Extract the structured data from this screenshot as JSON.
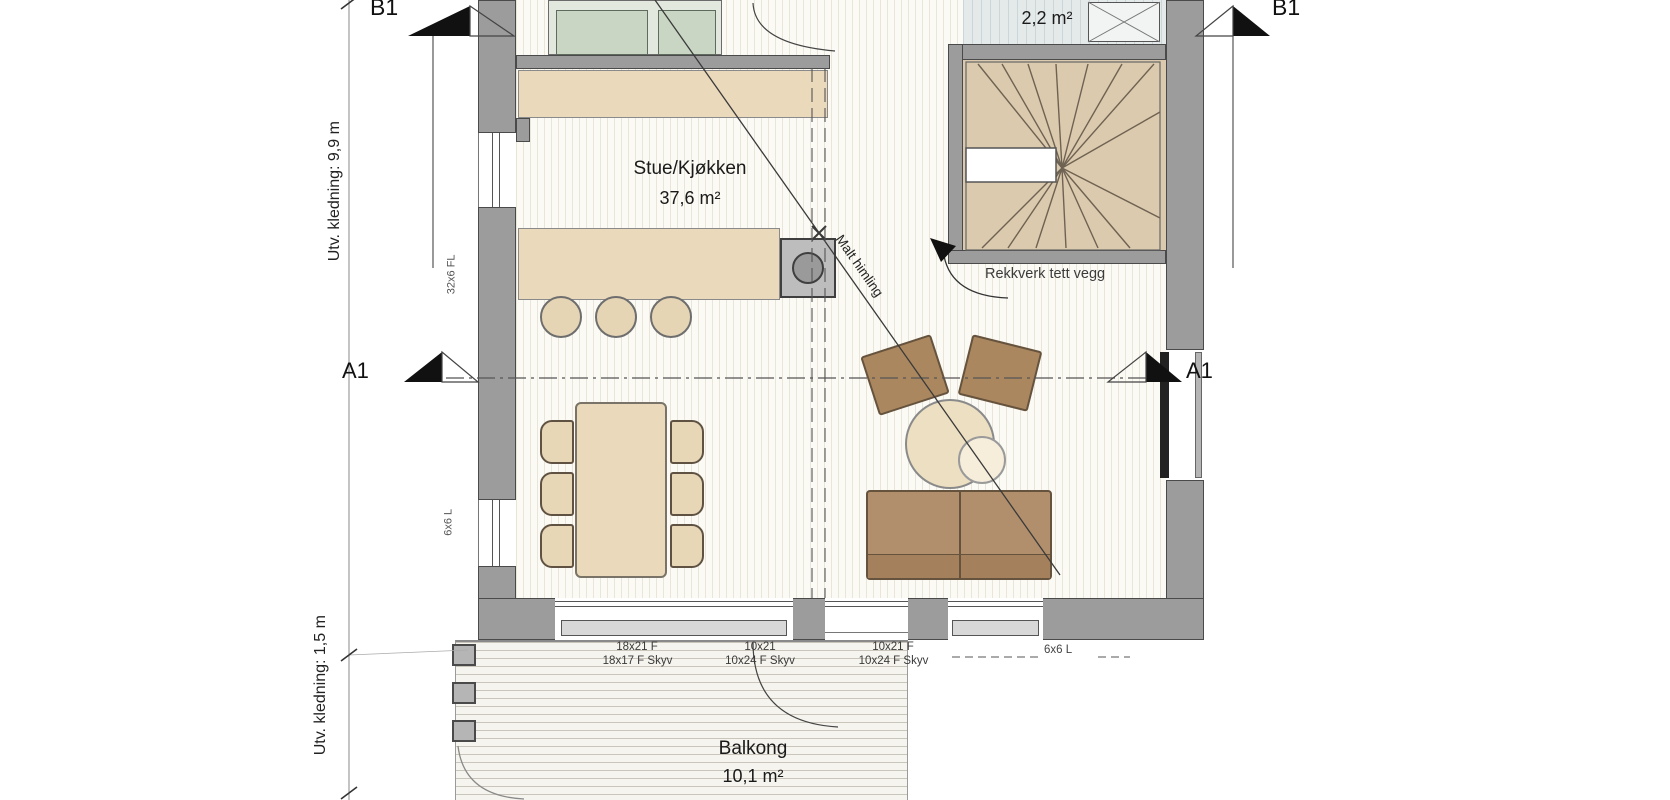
{
  "rooms": {
    "living": {
      "name": "Stue/Kjøkken",
      "area": "37,6 m²"
    },
    "wc": {
      "name": "WC",
      "area": "2,2 m²"
    },
    "balcony": {
      "name": "Balkong",
      "area": "10,1 m²"
    }
  },
  "annotations": {
    "railing": "Rekkverk tett vegg",
    "ceiling": "Malt himling",
    "cladding_upper": "Utv. kledning: 9,9 m",
    "cladding_lower": "Utv. kledning: 1,5 m",
    "beam_upper_left_wall": "32x6 FL",
    "beam_lower_left_wall": "6x6 L",
    "lintel_right": "6x6 L"
  },
  "section_markers": {
    "b1": "B1",
    "a1": "A1"
  },
  "window_labels": [
    {
      "code": "18x21 F",
      "type": "18x17 F Skyv"
    },
    {
      "code": "10x21",
      "type": "10x24 F Skyv"
    },
    {
      "code": "10x21 F",
      "type": "10x24 F Skyv"
    }
  ],
  "colors": {
    "wall": "#9c9c9c",
    "wall_edge": "#4a4a4a",
    "kitchen_cabinet": "#c9d6c4",
    "wood_furniture": "#ead9bb",
    "stair_tread": "#dccaae",
    "upholstery": "#ab875f",
    "wc_floor": "#e4e9ea",
    "marker": "#111111"
  }
}
